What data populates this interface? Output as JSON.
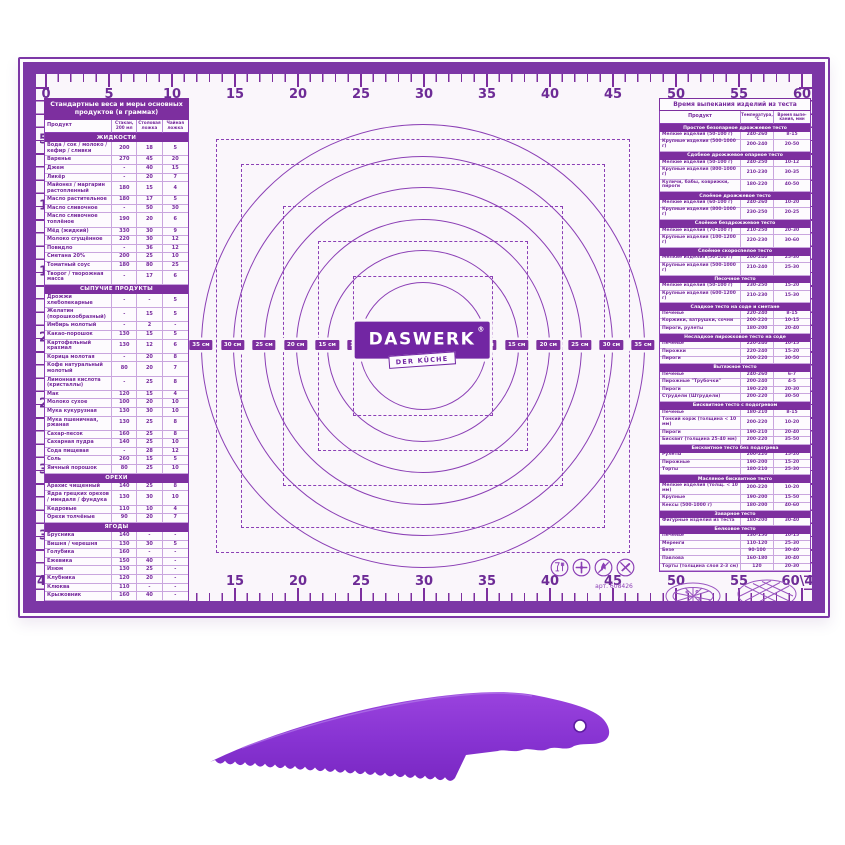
{
  "mat": {
    "brand": {
      "name": "DASWERK",
      "reg": "®",
      "tagline": "DER KÜCHE"
    },
    "art_number": "арт. 608426",
    "rulers": {
      "top": [
        "0",
        "5",
        "10",
        "15",
        "20",
        "25",
        "30",
        "35",
        "40",
        "45",
        "50",
        "55",
        "60"
      ],
      "bottom": [
        "40",
        "5",
        "10",
        "15",
        "20",
        "25",
        "30",
        "35",
        "40",
        "45",
        "50",
        "55",
        "60\\40"
      ],
      "left": [
        "5",
        "10",
        "15",
        "20",
        "25",
        "30",
        "35"
      ],
      "right": [
        "5",
        "10",
        "15",
        "20",
        "25",
        "30",
        "35"
      ]
    },
    "center": {
      "unit": "см",
      "diameters_cm": [
        35,
        30,
        25,
        20,
        15,
        10
      ]
    },
    "care_icons": [
      "food-safe-icon",
      "crossed-cutlery-icon",
      "no-open-flame-icon",
      "no-cutting-icon"
    ],
    "left_panel": {
      "title": "Стандартные веса и меры основных продуктов (в граммах)",
      "columns": [
        "Продукт",
        "Стакан, 200 мл",
        "Столовая ложка",
        "Чайная ложка"
      ],
      "sections": [
        {
          "name": "ЖИДКОСТИ",
          "rows": [
            [
              "Вода / сок / молоко / кефир / сливки",
              "200",
              "18",
              "5"
            ],
            [
              "Варенье",
              "270",
              "45",
              "20"
            ],
            [
              "Джем",
              "-",
              "40",
              "15"
            ],
            [
              "Ликёр",
              "-",
              "20",
              "7"
            ],
            [
              "Майонез / маргарин растопленный",
              "180",
              "15",
              "4"
            ],
            [
              "Масло растительное",
              "180",
              "17",
              "5"
            ],
            [
              "Масло сливочное",
              "-",
              "50",
              "30"
            ],
            [
              "Масло сливочное топлёное",
              "190",
              "20",
              "6"
            ],
            [
              "Мёд (жидкий)",
              "330",
              "30",
              "9"
            ],
            [
              "Молоко сгущённое",
              "220",
              "30",
              "12"
            ],
            [
              "Повидло",
              "-",
              "36",
              "12"
            ],
            [
              "Сметана 20%",
              "200",
              "25",
              "10"
            ],
            [
              "Томатный соус",
              "180",
              "80",
              "25"
            ],
            [
              "Творог / творожная масса",
              "-",
              "17",
              "6"
            ]
          ]
        },
        {
          "name": "СЫПУЧИЕ ПРОДУКТЫ",
          "rows": [
            [
              "Дрожжи хлебопекарные",
              "-",
              "-",
              "5"
            ],
            [
              "Желатин (порошкообразный)",
              "-",
              "15",
              "5"
            ],
            [
              "Имбирь молотый",
              "-",
              "2",
              "-"
            ],
            [
              "Какао-порошок",
              "130",
              "15",
              "5"
            ],
            [
              "Картофельный крахмал",
              "130",
              "12",
              "6"
            ],
            [
              "Корица молотая",
              "-",
              "20",
              "8"
            ],
            [
              "Кофе натуральный молотый",
              "80",
              "20",
              "7"
            ],
            [
              "Лимонная кислота (кристаллы)",
              "-",
              "25",
              "8"
            ],
            [
              "Мак",
              "120",
              "15",
              "4"
            ],
            [
              "Молоко сухое",
              "100",
              "20",
              "10"
            ],
            [
              "Мука кукурузная",
              "130",
              "30",
              "10"
            ],
            [
              "Мука пшеничная, ржаная",
              "130",
              "25",
              "8"
            ],
            [
              "Сахар-песок",
              "160",
              "25",
              "8"
            ],
            [
              "Сахарная пудра",
              "140",
              "25",
              "10"
            ],
            [
              "Сода пищевая",
              "-",
              "28",
              "12"
            ],
            [
              "Соль",
              "260",
              "15",
              "5"
            ],
            [
              "Яичный порошок",
              "80",
              "25",
              "10"
            ]
          ]
        },
        {
          "name": "ОРЕХИ",
          "rows": [
            [
              "Арахис чищенный",
              "140",
              "25",
              "8"
            ],
            [
              "Ядра грецких орехов / миндаля / фундука",
              "130",
              "30",
              "10"
            ],
            [
              "Кедровые",
              "110",
              "10",
              "4"
            ],
            [
              "Орехи толчёные",
              "90",
              "20",
              "7"
            ]
          ]
        },
        {
          "name": "ЯГОДЫ",
          "rows": [
            [
              "Брусника",
              "140",
              "-",
              "-"
            ],
            [
              "Вишня / черешня",
              "130",
              "30",
              "5"
            ],
            [
              "Голубика",
              "160",
              "-",
              "-"
            ],
            [
              "Ежевика",
              "150",
              "40",
              "-"
            ],
            [
              "Изюм",
              "130",
              "25",
              "-"
            ],
            [
              "Клубника",
              "120",
              "20",
              "-"
            ],
            [
              "Клюква",
              "110",
              "-",
              "-"
            ],
            [
              "Крыжовник",
              "160",
              "40",
              "-"
            ],
            [
              "Малина",
              "145",
              "20",
              "-"
            ],
            [
              "Смородина красная / белая",
              "140",
              "35",
              "-"
            ],
            [
              "Смородина чёрная",
              "125",
              "30",
              "-"
            ],
            [
              "Черника",
              "160",
              "-",
              "-"
            ],
            [
              "Шелковица",
              "135",
              "40",
              "-"
            ],
            [
              "Шиповник засушенный",
              "-",
              "20",
              "6"
            ]
          ]
        }
      ],
      "qr": {
        "text": "Заходите по ссылкам в QR-кодах на наши каналы в YouTube и VK, чтобы найти больше полезной информации и рецептов",
        "codes": [
          {
            "name": "vk-qr-code",
            "logo": "VK"
          },
          {
            "name": "youtube-qr-code",
            "logo": "►"
          }
        ]
      }
    },
    "right_panel": {
      "baking_table": {
        "title": "Время выпекания изделий из теста",
        "columns": [
          "Продукт",
          "Температура, °C",
          "Время выпе- кания, мин"
        ],
        "sections": [
          {
            "name": "Простое безопарное дрожжевое тесто",
            "rows": [
              [
                "Мелкие изделия (50-100 г)",
                "240-260",
                "8-15"
              ],
              [
                "Крупные изделия (500-1000 г)",
                "200-240",
                "20-50"
              ]
            ]
          },
          {
            "name": "Сдобное дрожжевое опарное тесто",
            "rows": [
              [
                "Мелкие изделия (50-100 г)",
                "240-250",
                "10-12"
              ],
              [
                "Крупные изделия (800-1000 г)",
                "210-230",
                "30-35"
              ],
              [
                "Куличи, бабы, коврижки, пироги",
                "180-220",
                "40-50"
              ]
            ]
          },
          {
            "name": "Слоёное дрожжевое тесто",
            "rows": [
              [
                "Мелкие изделия (60-100 г)",
                "240-260",
                "10-20"
              ],
              [
                "Крупные изделия (800-1000 г)",
                "230-250",
                "20-25"
              ]
            ]
          },
          {
            "name": "Слоёное бездрожжевое тесто",
            "rows": [
              [
                "Мелкие изделия (70-100 г)",
                "210-250",
                "20-30"
              ],
              [
                "Крупные изделия (100-1200 г)",
                "220-230",
                "30-60"
              ]
            ]
          },
          {
            "name": "Слоёное скороспелое тесто",
            "rows": [
              [
                "Мелкие изделия (50-100 г)",
                "200-240",
                "25-30"
              ],
              [
                "Крупные изделия (500-1000 г)",
                "210-240",
                "25-30"
              ]
            ]
          },
          {
            "name": "Песочное тесто",
            "rows": [
              [
                "Мелкие изделия (50-100 г)",
                "230-250",
                "15-20"
              ],
              [
                "Крупные изделия (600-1200 г)",
                "210-230",
                "15-30"
              ]
            ]
          },
          {
            "name": "Сладкое тесто на соде и сметане",
            "rows": [
              [
                "Печенье",
                "220-240",
                "8-15"
              ],
              [
                "Коржики, ватрушки, сочни",
                "200-220",
                "10-15"
              ],
              [
                "Пироги, рулеты",
                "180-200",
                "20-40"
              ]
            ]
          },
          {
            "name": "Несладкое пирожковое тесто на соде",
            "rows": [
              [
                "Печенье",
                "220-240",
                "10-15"
              ],
              [
                "Пирожки",
                "220-240",
                "15-20"
              ],
              [
                "Пироги",
                "200-220",
                "30-50"
              ]
            ]
          },
          {
            "name": "Вытяжное тесто",
            "rows": [
              [
                "Печенье",
                "240-260",
                "6-7"
              ],
              [
                "Пирожные \"Трубочки\"",
                "200-240",
                "4-5"
              ],
              [
                "Пироги",
                "190-220",
                "20-30"
              ],
              [
                "Струдели (Штрудели)",
                "200-220",
                "30-50"
              ]
            ]
          },
          {
            "name": "Бисквитное тесто с подогревом",
            "rows": [
              [
                "Печенье",
                "180-210",
                "8-15"
              ],
              [
                "Тонкий корж (толщина < 10 мм)",
                "200-220",
                "10-20"
              ],
              [
                "Пироги",
                "190-210",
                "20-40"
              ],
              [
                "Бисквит (толщина 25-40 мм)",
                "200-220",
                "35-50"
              ]
            ]
          },
          {
            "name": "Бисквитное тесто без подогрева",
            "rows": [
              [
                "Рулеты",
                "200-220",
                "15-20"
              ],
              [
                "Пирожные",
                "190-200",
                "15-20"
              ],
              [
                "Торты",
                "180-210",
                "25-30"
              ]
            ]
          },
          {
            "name": "Масляное бисквитное тесто",
            "rows": [
              [
                "Мелкие изделия (толщ. < 10 мм)",
                "200-220",
                "10-20"
              ],
              [
                "Крупные",
                "190-200",
                "15-50"
              ],
              [
                "Кексы (500-1000 г)",
                "180-200",
                "40-60"
              ]
            ]
          },
          {
            "name": "Заварное тесто",
            "rows": [
              [
                "Фигурные изделия из теста",
                "180-200",
                "30-40"
              ]
            ]
          },
          {
            "name": "Белковое тесто",
            "rows": [
              [
                "Печенье",
                "130-150",
                "10-15"
              ],
              [
                "Меренги",
                "110-120",
                "25-30"
              ],
              [
                "Безе",
                "90-100",
                "30-40"
              ],
              [
                "Павлова",
                "160-180",
                "30-40"
              ],
              [
                "Торты (толщина слоя 2-3 см)",
                "120",
                "20-30"
              ]
            ]
          }
        ]
      },
      "roasting_table": {
        "title": "Температура и примерное время запекания в духовке мяса и рыбы",
        "columns": [
          "Продукт",
          "Температура, °C",
          "Запекание порции (500 г), мин"
        ],
        "groups": [
          {
            "name": "БАРАНИНА",
            "rows": [
              [
                "Нога на кости",
                "230",
                "15"
              ],
              [
                "Рулет фаршированный",
                "220",
                "15"
              ],
              [
                "Лопатка",
                "220",
                "13"
              ],
              [
                "Рёбра",
                "210",
                "12"
              ]
            ]
          },
          {
            "name": "ГОВЯДИНА, ТЕЛЯТИНА",
            "rows": [
              [
                "Вырезка",
                "180",
                "12-14"
              ],
              [
                "Грудинка",
                "200",
                "25-30"
              ],
              [
                "Лопатка",
                "190",
                "30-35"
              ],
              [
                "Филейная часть",
                "190",
                "20-25"
              ],
              [
                "Рулет фаршированный",
                "190",
                "24-28"
              ],
              [
                "Рёберная часть",
                "180",
                "20-25"
              ]
            ]
          },
          {
            "name": "СВИНИНА",
            "rows": [
              [
                "Шея, окорок",
                "180",
                "25"
              ],
              [
                "Вырезка, филе",
                "180",
                "20"
              ],
              [
                "Рёбра",
                "200",
                "25"
              ]
            ]
          },
          {
            "name": "ПТИЦА",
            "rows": [
              [
                "Курица",
                "180",
                "20"
              ],
              [
                "Утка",
                "200",
                "12"
              ],
              [
                "Индейка",
                "180",
                "12"
              ],
              [
                "Гусь",
                "200",
                "15"
              ]
            ]
          },
          {
            "name": "РЫБА",
            "rows": [
              [
                "Любая, фаршированная",
                "180",
                "10 минут на каждые 2,5 см толщины"
              ],
              [
                "Рыба целиком",
                "180",
                "25-30"
              ]
            ]
          }
        ]
      }
    }
  }
}
